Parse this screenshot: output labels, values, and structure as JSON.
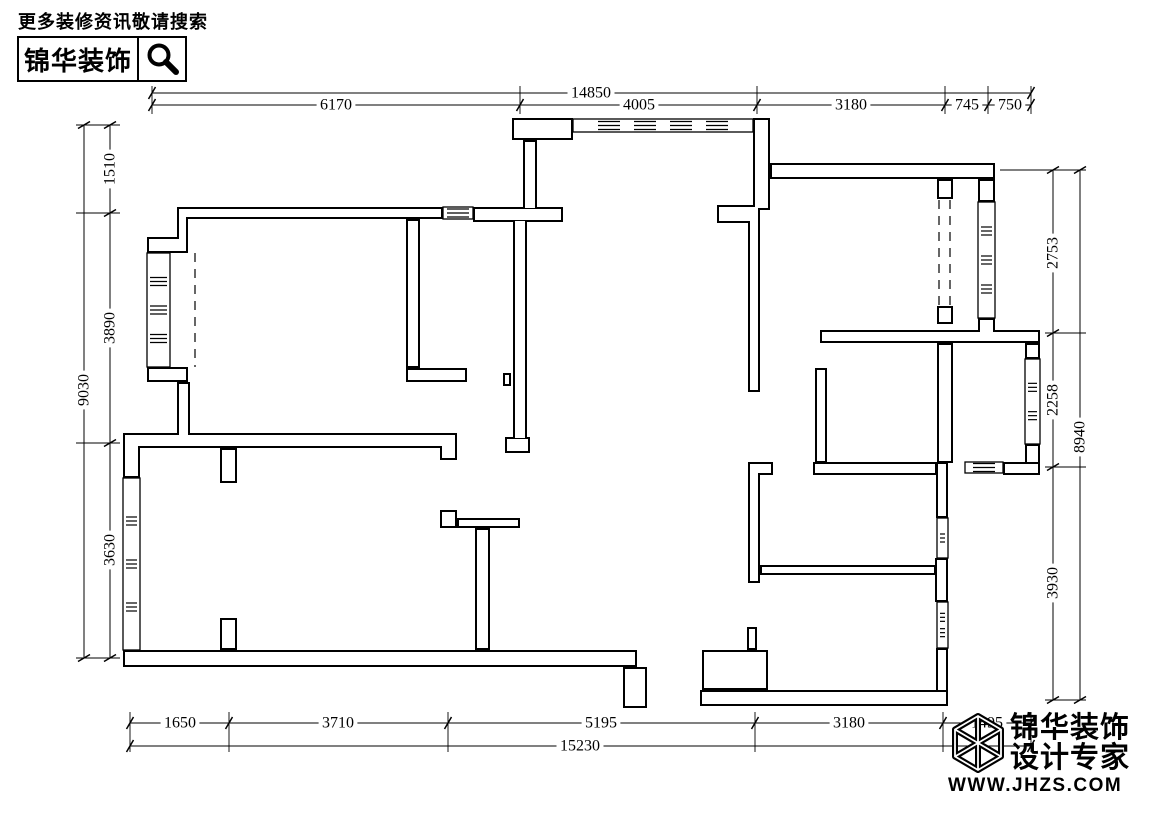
{
  "header": {
    "promo_text": "更多装修资讯敬请搜索",
    "brand_name": "锦华装饰"
  },
  "floorplan": {
    "dimensions": {
      "top": {
        "total": "14850",
        "segments": [
          "6170",
          "4005",
          "3180",
          "745",
          "750"
        ]
      },
      "bottom": {
        "total": "15230",
        "segments": [
          "1650",
          "3710",
          "5195",
          "3180",
          "1495"
        ]
      },
      "left": {
        "total": "9030",
        "segments": [
          "1510",
          "3890",
          "3630"
        ]
      },
      "right": {
        "total": "8940",
        "segments": [
          "2753",
          "2258",
          "3930"
        ]
      }
    }
  },
  "watermark": {
    "brand_name": "锦华装饰",
    "tagline": "设计专家",
    "url": "WWW.JHZS.COM"
  },
  "colors": {
    "line": "#000000",
    "background": "#ffffff"
  }
}
